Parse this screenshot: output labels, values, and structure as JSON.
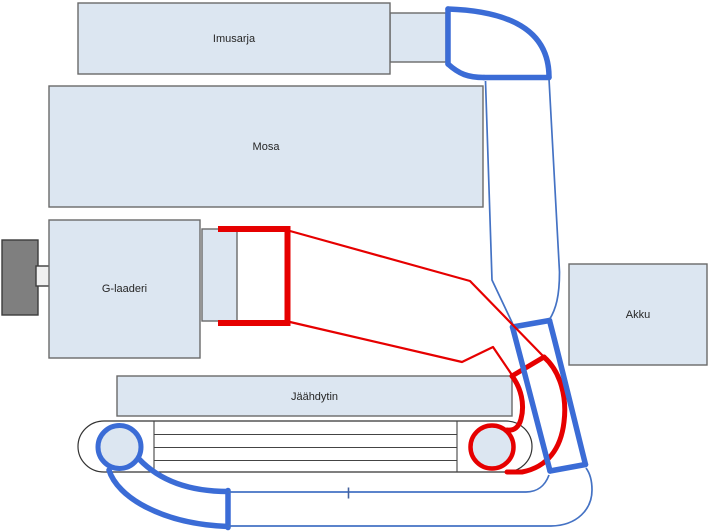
{
  "diagram": {
    "labels": {
      "imusarja": "Imusarja",
      "mosa": "Mosa",
      "g_laaderi": "G-laaderi",
      "jaahdytin": "Jäähdytin",
      "akku": "Akku"
    },
    "colors": {
      "component_fill": "#dce6f1",
      "component_border": "#6a6a6a",
      "pipe_red": "#e60000",
      "pipe_blue_thick": "#3b6cd6",
      "pipe_blue_thin": "#4472c4",
      "shaft_block_gray": "#7f7f7f",
      "intercooler_outline": "#333333"
    }
  }
}
